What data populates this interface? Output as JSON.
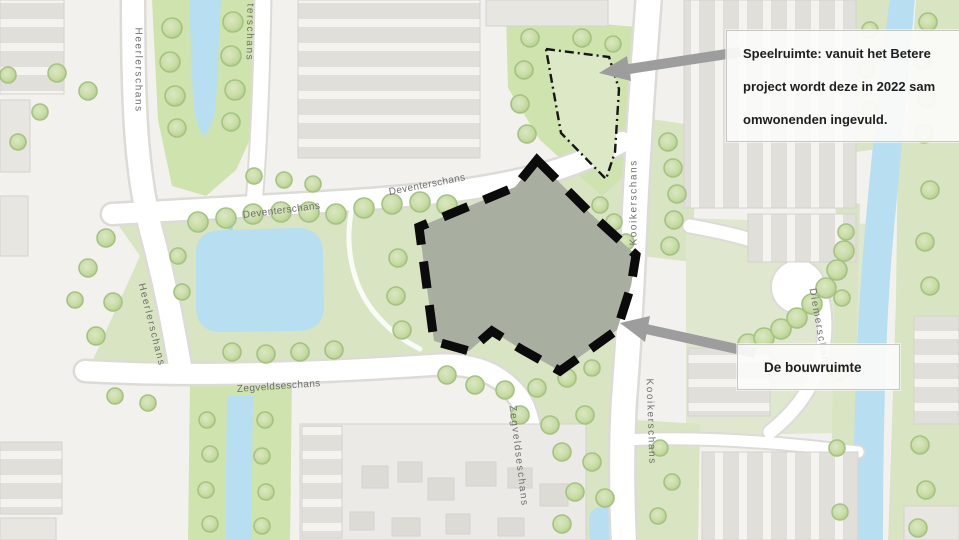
{
  "figure": {
    "title": "Situatiekaart met speelruimte en bouwruimte",
    "type": "annotated-map"
  },
  "streets": [
    {
      "name": "Heerlerschans"
    },
    {
      "name": "terschans"
    },
    {
      "name": "Deventerschans"
    },
    {
      "name": "Deventerschans"
    },
    {
      "name": "Kooikerschans"
    },
    {
      "name": "Heerlerschans"
    },
    {
      "name": "Zegveldseschans"
    },
    {
      "name": "Zegveldseschans"
    },
    {
      "name": "Kooikerschans"
    },
    {
      "name": "Diemerschans"
    }
  ],
  "annotations": {
    "speelruimte": {
      "lines": [
        "Speelruimte: vanuit het Betere",
        "project wordt deze in 2022 sam",
        "omwonenden ingevuld."
      ]
    },
    "bouwruimte": {
      "label": "De bouwruimte"
    }
  },
  "legend_colors": {
    "water": "#b7dff1",
    "park_green": "#d8e4c2",
    "bright_green": "#cfe3ae",
    "building": "#e9e8e3",
    "road": "#ffffff",
    "site_fill": "#a9afa0",
    "site_border": "#0b0b0b",
    "play_area_fill": "#dce8c6",
    "arrow": "#9d9d9d",
    "street_label": "#6f6f6d",
    "callout_background": "#fbfbf9",
    "callout_border": "#c7c7c3"
  }
}
